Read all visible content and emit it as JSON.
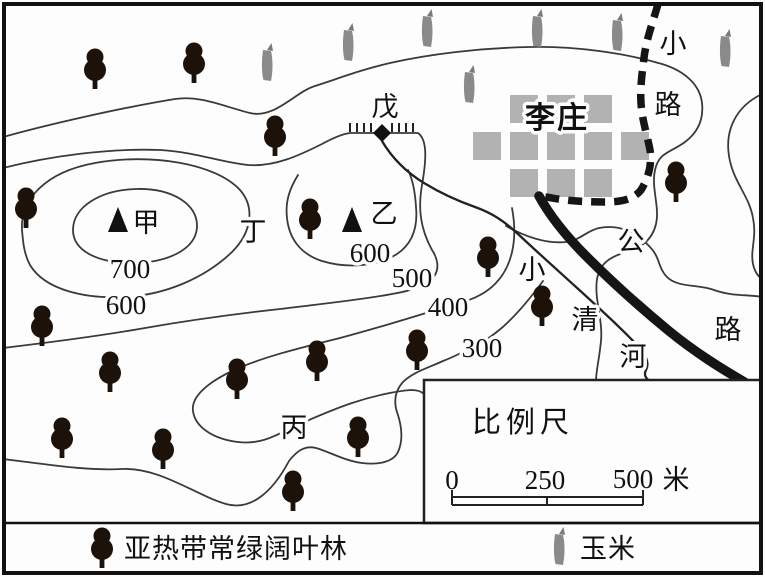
{
  "map": {
    "peaks": [
      {
        "id": "jia",
        "label": "甲"
      },
      {
        "id": "yi",
        "label": "乙"
      }
    ],
    "spots": {
      "ding": "丁",
      "wu": "戊",
      "bing": "丙"
    },
    "village_name": "李庄",
    "trail_label": {
      "c1": "小",
      "c2": "路"
    },
    "highway_label": {
      "c1": "公",
      "c2": "路"
    },
    "river_label": {
      "c1": "小",
      "c2": "清",
      "c3": "河"
    },
    "contour_labels": {
      "c700": "700",
      "c600_jia": "600",
      "c600_yi": "600",
      "c500": "500",
      "c400": "400",
      "c300": "300"
    },
    "village_blocks": {
      "size": 28,
      "rows": [
        {
          "y": 95,
          "xs": [
            510,
            547,
            584
          ]
        },
        {
          "y": 132,
          "xs": [
            473,
            510,
            547,
            584,
            621
          ]
        },
        {
          "y": 169,
          "xs": [
            510,
            547,
            584
          ]
        }
      ]
    },
    "trees": [
      [
        95,
        68
      ],
      [
        194,
        62
      ],
      [
        275,
        135
      ],
      [
        26,
        207
      ],
      [
        310,
        218
      ],
      [
        676,
        181
      ],
      [
        488,
        256
      ],
      [
        542,
        305
      ],
      [
        42,
        325
      ],
      [
        317,
        360
      ],
      [
        110,
        371
      ],
      [
        237,
        378
      ],
      [
        417,
        349
      ],
      [
        62,
        437
      ],
      [
        163,
        448
      ],
      [
        358,
        436
      ],
      [
        293,
        490
      ]
    ],
    "corn": [
      [
        267,
        64
      ],
      [
        348,
        44
      ],
      [
        427,
        30
      ],
      [
        469,
        86
      ],
      [
        537,
        30
      ],
      [
        617,
        34
      ],
      [
        725,
        50
      ]
    ],
    "colors": {
      "contour": "#3a3a3a",
      "road": "#151515",
      "block": "#b2b2b2",
      "tree": "#1c120a",
      "corn": "#8a8a8a"
    }
  },
  "scale_box": {
    "title": "比例尺",
    "tick0": "0",
    "tick250": "250",
    "tick500": "500",
    "unit": "米"
  },
  "legend": {
    "forest": "亚热带常绿阔叶林",
    "corn": "玉米"
  }
}
